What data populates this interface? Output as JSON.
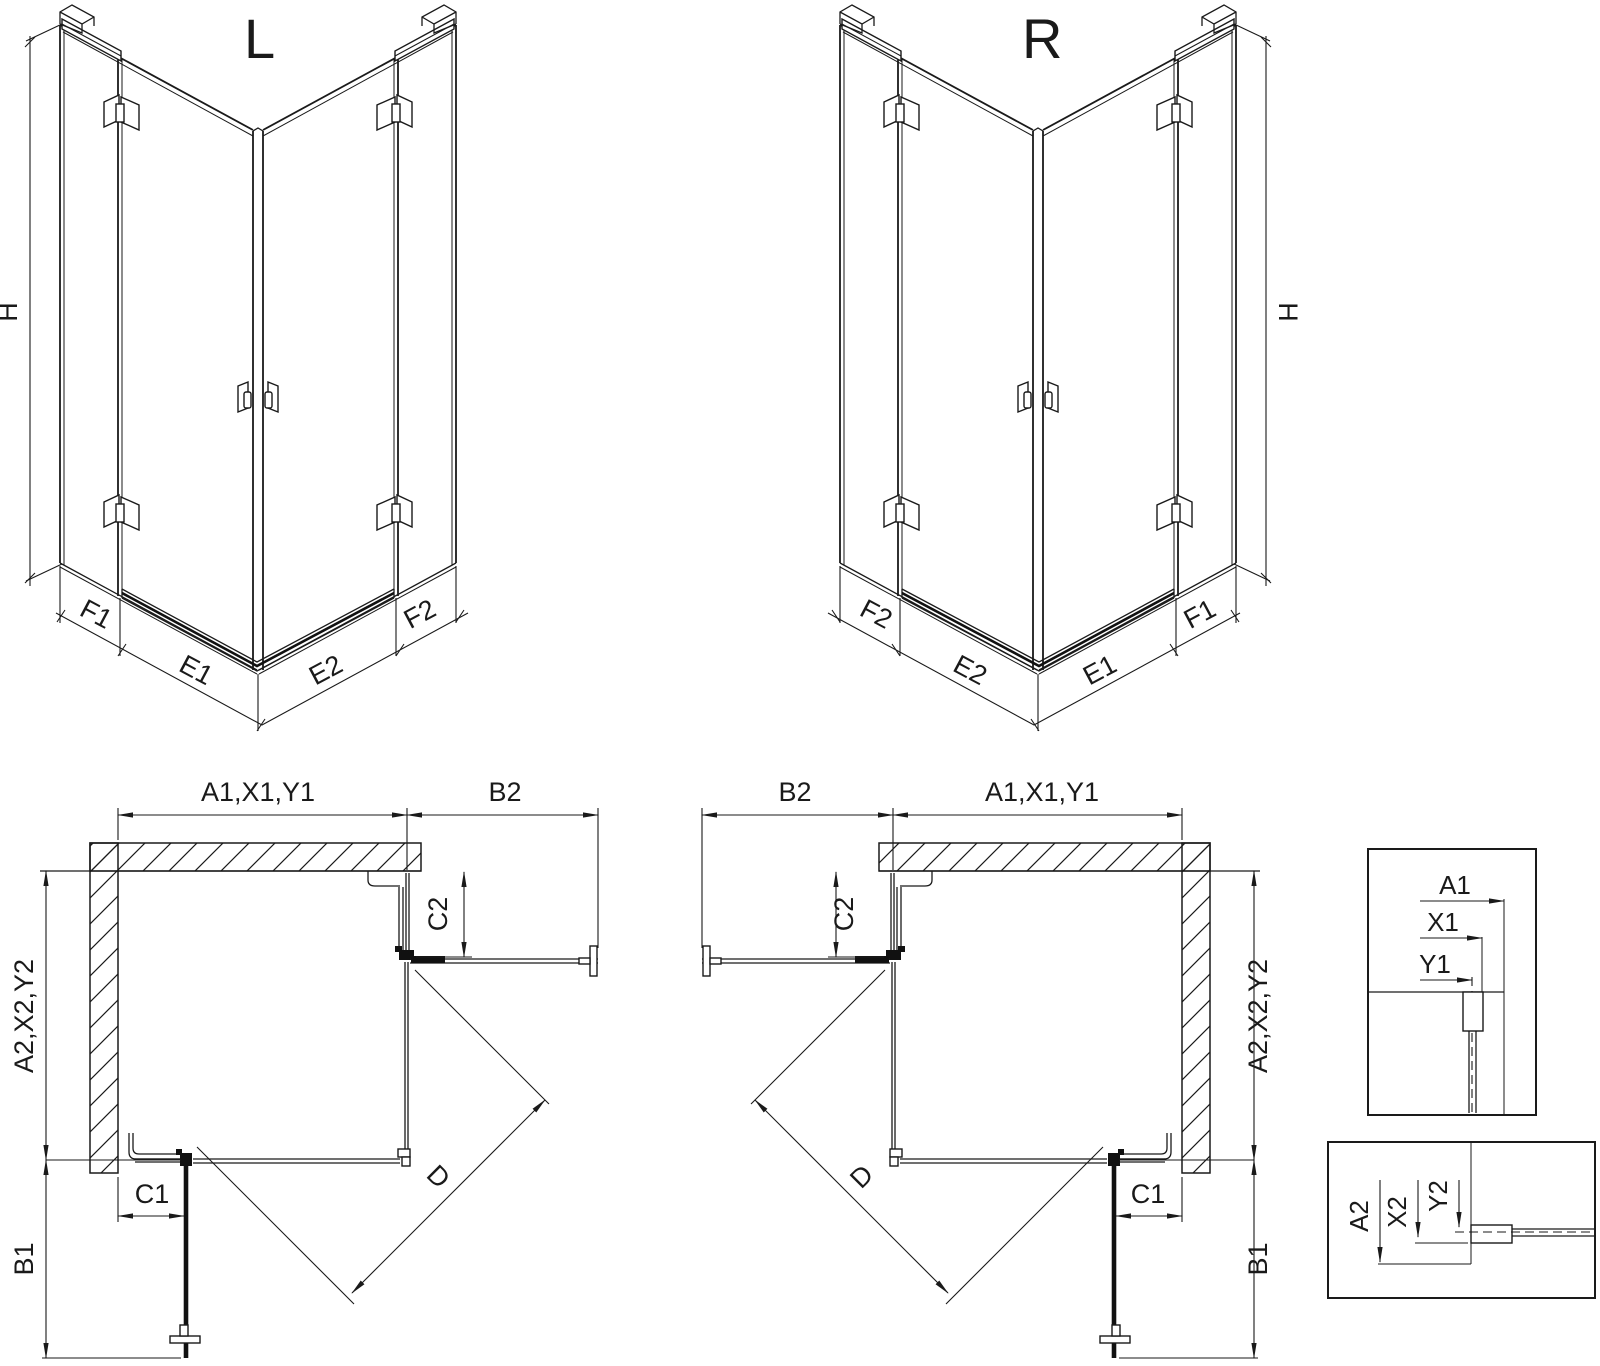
{
  "ink": "#1a1a1a",
  "background": "#ffffff",
  "iso_left": {
    "title": "L",
    "h": "H",
    "f1": "F1",
    "e1": "E1",
    "e2": "E2",
    "f2": "F2"
  },
  "iso_right": {
    "title": "R",
    "h": "H",
    "f1": "F1",
    "e1": "E1",
    "e2": "E2",
    "f2": "F2"
  },
  "plan_left": {
    "a1": "A1,X1,Y1",
    "b2": "B2",
    "c2": "C2",
    "a2": "A2,X2,Y2",
    "c1": "C1",
    "b1": "B1",
    "d": "D"
  },
  "plan_right": {
    "a1": "A1,X1,Y1",
    "b2": "B2",
    "c2": "C2",
    "a2": "A2,X2,Y2",
    "c1": "C1",
    "b1": "B1",
    "d": "D"
  },
  "detail_top": {
    "a1": "A1",
    "x1": "X1",
    "y1": "Y1"
  },
  "detail_bottom": {
    "a2": "A2",
    "x2": "X2",
    "y2": "Y2"
  }
}
